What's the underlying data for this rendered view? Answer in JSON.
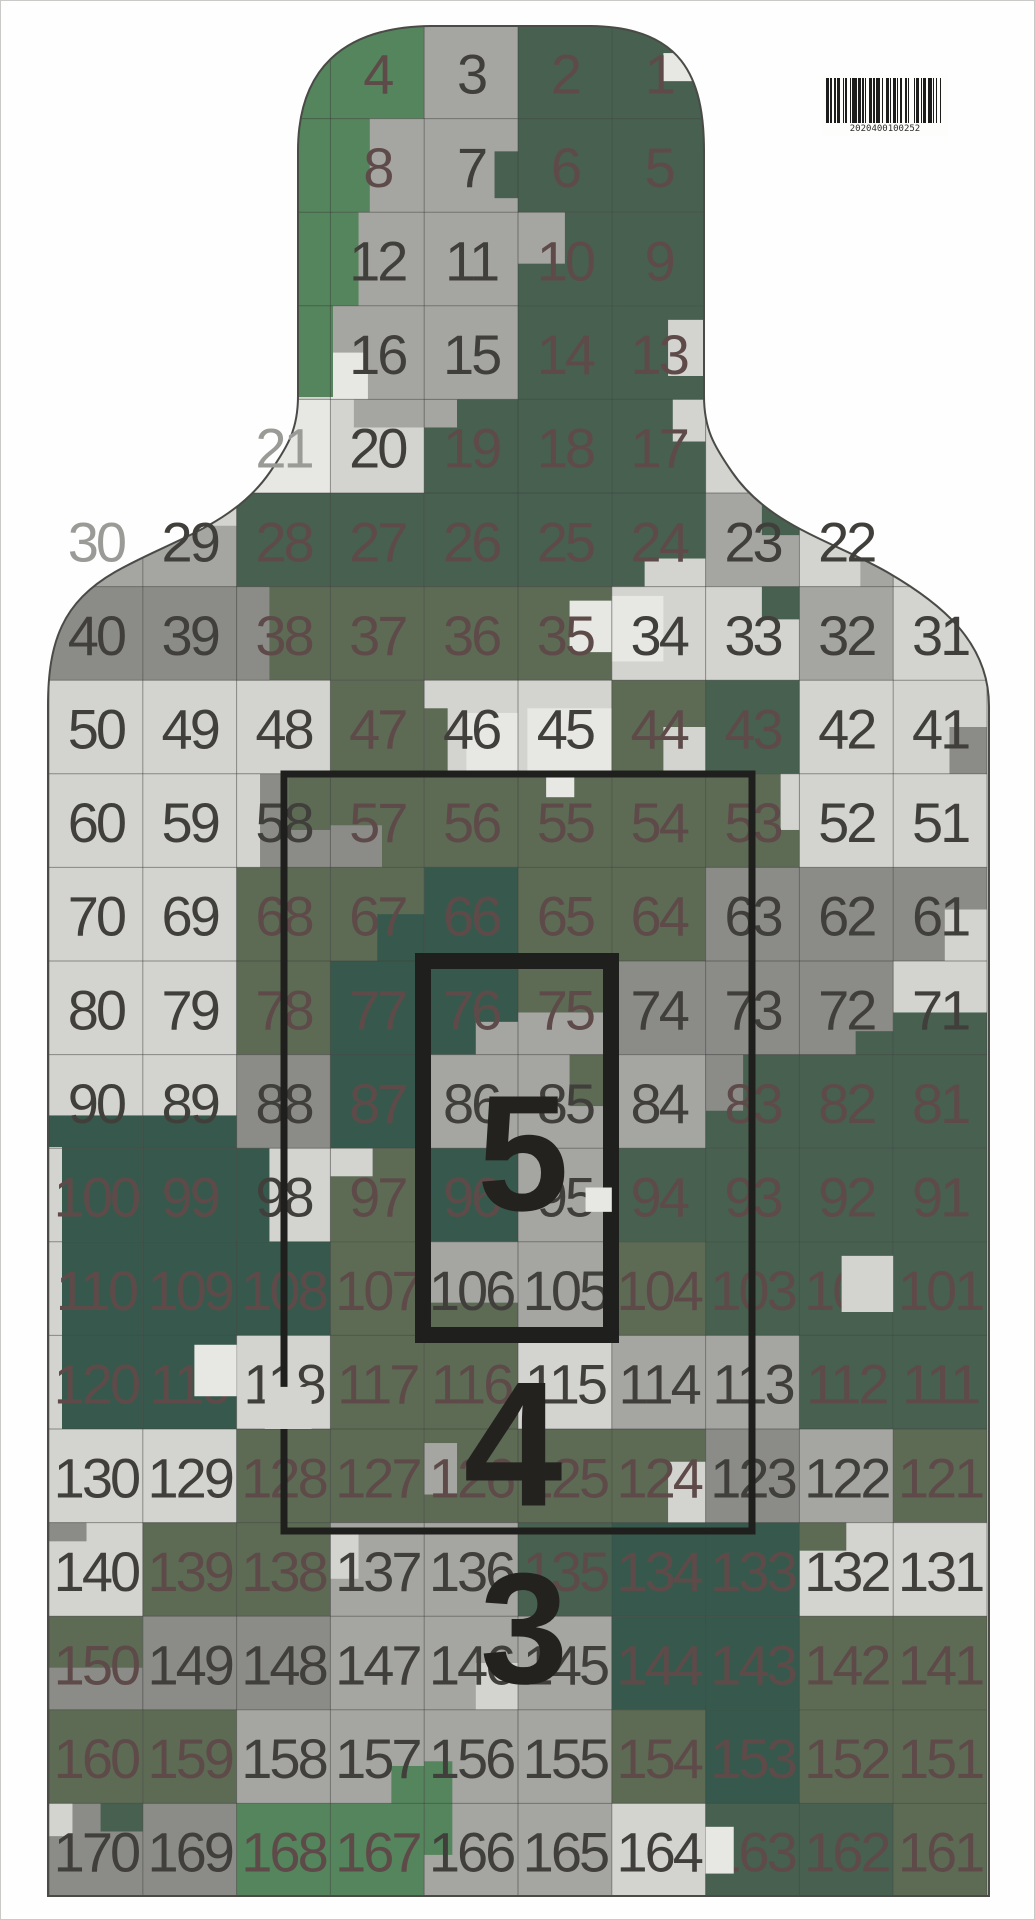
{
  "document": {
    "type": "camouflage-silhouette-shooting-target",
    "page_width": 1035,
    "page_height": 1920
  },
  "palette": {
    "W": "#e7e7e4",
    "L": "#d3d3d0",
    "M": "#a5a5a2",
    "G": "#8b8b88",
    "O": "#5d6b55",
    "D": "#47604f",
    "T": "#37594d",
    "B": "#55855c",
    "base": "#d3d3d0",
    "outline": "#4a4a47",
    "grid_line": "rgba(60,60,58,0.5)",
    "ring_stroke": "#1f1f1d",
    "label_color": "#23221f"
  },
  "inks": {
    "d": "#413f3b",
    "m": "#5e4b49",
    "g": "#9a9a97"
  },
  "grid": {
    "x0": 48,
    "y0": 24,
    "cw": 93.8,
    "rh": 93.6,
    "cols": 10,
    "rows": 20
  },
  "outline_path": "M 47 705 C 47 640 62 601 114 571 C 168 540 232 525 269 471 C 287 445 297 428 297 395 L 297 150 C 297 70 340 26 430 25 L 590 25 C 680 26 703 75 703 150 L 703 395 C 703 428 713 445 731 471 C 768 525 832 540 886 571 C 938 601 988 640 988 705 L 988 1895 L 47 1895 Z",
  "rows": [
    {
      "s": 3,
      "c": [
        [
          4,
          "B"
        ],
        [
          3,
          "M"
        ],
        [
          2,
          "D"
        ],
        [
          1,
          "D"
        ]
      ]
    },
    {
      "s": 3,
      "c": [
        [
          8,
          "M",
          "m"
        ],
        [
          7,
          "M"
        ],
        [
          6,
          "D"
        ],
        [
          5,
          "D"
        ]
      ]
    },
    {
      "s": 3,
      "c": [
        [
          12,
          "M"
        ],
        [
          11,
          "M"
        ],
        [
          10,
          "D"
        ],
        [
          9,
          "D"
        ]
      ]
    },
    {
      "s": 3,
      "c": [
        [
          16,
          "M"
        ],
        [
          15,
          "M"
        ],
        [
          14,
          "D"
        ],
        [
          13,
          "D"
        ]
      ]
    },
    {
      "s": 2,
      "c": [
        [
          21,
          "W",
          "g"
        ],
        [
          20,
          "L"
        ],
        [
          19,
          "D"
        ],
        [
          18,
          "D"
        ],
        [
          17,
          "D"
        ]
      ]
    },
    {
      "s": 0,
      "c": [
        [
          30,
          "W",
          "g"
        ],
        [
          29,
          "M"
        ],
        [
          28,
          "D"
        ],
        [
          27,
          "D"
        ],
        [
          26,
          "D"
        ],
        [
          25,
          "D"
        ],
        [
          24,
          "D"
        ],
        [
          23,
          "M"
        ],
        [
          22,
          "L"
        ]
      ]
    },
    {
      "s": 0,
      "c": [
        [
          40,
          "G"
        ],
        [
          39,
          "G"
        ],
        [
          38,
          "O"
        ],
        [
          37,
          "O"
        ],
        [
          36,
          "O"
        ],
        [
          35,
          "O"
        ],
        [
          34,
          "L"
        ],
        [
          33,
          "L"
        ],
        [
          32,
          "M"
        ],
        [
          31,
          "L"
        ]
      ]
    },
    {
      "s": 0,
      "c": [
        [
          50,
          "L"
        ],
        [
          49,
          "L"
        ],
        [
          48,
          "L"
        ],
        [
          47,
          "O"
        ],
        [
          46,
          "L"
        ],
        [
          45,
          "L"
        ],
        [
          44,
          "O"
        ],
        [
          43,
          "D"
        ],
        [
          42,
          "L"
        ],
        [
          41,
          "L"
        ]
      ]
    },
    {
      "s": 0,
      "c": [
        [
          60,
          "L"
        ],
        [
          59,
          "L"
        ],
        [
          58,
          "G"
        ],
        [
          57,
          "O"
        ],
        [
          56,
          "O"
        ],
        [
          55,
          "O"
        ],
        [
          54,
          "O"
        ],
        [
          53,
          "O"
        ],
        [
          52,
          "L"
        ],
        [
          51,
          "L"
        ]
      ]
    },
    {
      "s": 0,
      "c": [
        [
          70,
          "L"
        ],
        [
          69,
          "L"
        ],
        [
          68,
          "O"
        ],
        [
          67,
          "O"
        ],
        [
          66,
          "T"
        ],
        [
          65,
          "O"
        ],
        [
          64,
          "O"
        ],
        [
          63,
          "G"
        ],
        [
          62,
          "G"
        ],
        [
          61,
          "G"
        ]
      ]
    },
    {
      "s": 0,
      "c": [
        [
          80,
          "L"
        ],
        [
          79,
          "L"
        ],
        [
          78,
          "O"
        ],
        [
          77,
          "T"
        ],
        [
          76,
          "T"
        ],
        [
          75,
          "O"
        ],
        [
          74,
          "G"
        ],
        [
          73,
          "G"
        ],
        [
          72,
          "G"
        ],
        [
          71,
          "L"
        ]
      ]
    },
    {
      "s": 0,
      "c": [
        [
          90,
          "L"
        ],
        [
          89,
          "L"
        ],
        [
          88,
          "G"
        ],
        [
          87,
          "T"
        ],
        [
          86,
          "M"
        ],
        [
          85,
          "M"
        ],
        [
          84,
          "M"
        ],
        [
          83,
          "D"
        ],
        [
          82,
          "D"
        ],
        [
          81,
          "D"
        ]
      ]
    },
    {
      "s": 0,
      "c": [
        [
          100,
          "T"
        ],
        [
          99,
          "T"
        ],
        [
          98,
          "L"
        ],
        [
          97,
          "O"
        ],
        [
          96,
          "T"
        ],
        [
          95,
          "M"
        ],
        [
          94,
          "D"
        ],
        [
          93,
          "D"
        ],
        [
          92,
          "D"
        ],
        [
          91,
          "D"
        ]
      ]
    },
    {
      "s": 0,
      "c": [
        [
          110,
          "T"
        ],
        [
          109,
          "T"
        ],
        [
          108,
          "T"
        ],
        [
          107,
          "O"
        ],
        [
          106,
          "M"
        ],
        [
          105,
          "M"
        ],
        [
          104,
          "O"
        ],
        [
          103,
          "D"
        ],
        [
          102,
          "D"
        ],
        [
          101,
          "D"
        ]
      ]
    },
    {
      "s": 0,
      "c": [
        [
          120,
          "T"
        ],
        [
          119,
          "T"
        ],
        [
          118,
          "L"
        ],
        [
          117,
          "O"
        ],
        [
          116,
          "O"
        ],
        [
          115,
          "L"
        ],
        [
          114,
          "M"
        ],
        [
          113,
          "M"
        ],
        [
          112,
          "D"
        ],
        [
          111,
          "D"
        ]
      ]
    },
    {
      "s": 0,
      "c": [
        [
          130,
          "L"
        ],
        [
          129,
          "L"
        ],
        [
          128,
          "O"
        ],
        [
          127,
          "O"
        ],
        [
          126,
          "O"
        ],
        [
          125,
          "O"
        ],
        [
          124,
          "O"
        ],
        [
          123,
          "G"
        ],
        [
          122,
          "M"
        ],
        [
          121,
          "O"
        ]
      ]
    },
    {
      "s": 0,
      "c": [
        [
          140,
          "L"
        ],
        [
          139,
          "O"
        ],
        [
          138,
          "O"
        ],
        [
          137,
          "M"
        ],
        [
          136,
          "M"
        ],
        [
          135,
          "D"
        ],
        [
          134,
          "T"
        ],
        [
          133,
          "T"
        ],
        [
          132,
          "L"
        ],
        [
          131,
          "L"
        ]
      ]
    },
    {
      "s": 0,
      "c": [
        [
          150,
          "O"
        ],
        [
          149,
          "G"
        ],
        [
          148,
          "G"
        ],
        [
          147,
          "M"
        ],
        [
          146,
          "M"
        ],
        [
          145,
          "M"
        ],
        [
          144,
          "T"
        ],
        [
          143,
          "T"
        ],
        [
          142,
          "O"
        ],
        [
          141,
          "O"
        ]
      ]
    },
    {
      "s": 0,
      "c": [
        [
          160,
          "O"
        ],
        [
          159,
          "O"
        ],
        [
          158,
          "M"
        ],
        [
          157,
          "M"
        ],
        [
          156,
          "M"
        ],
        [
          155,
          "M"
        ],
        [
          154,
          "O"
        ],
        [
          153,
          "T"
        ],
        [
          152,
          "O"
        ],
        [
          151,
          "O"
        ]
      ]
    },
    {
      "s": 0,
      "c": [
        [
          170,
          "G"
        ],
        [
          169,
          "G"
        ],
        [
          168,
          "B"
        ],
        [
          167,
          "B"
        ],
        [
          166,
          "M"
        ],
        [
          165,
          "M"
        ],
        [
          164,
          "L"
        ],
        [
          163,
          "D"
        ],
        [
          162,
          "D"
        ],
        [
          161,
          "O"
        ]
      ]
    }
  ],
  "patches": [
    [
      0,
      6,
      "W",
      0.55,
      0.3,
      0.4,
      0.3
    ],
    [
      1,
      3,
      "B",
      0,
      0,
      0.42,
      1
    ],
    [
      1,
      4,
      "D",
      0.75,
      0.35,
      0.25,
      0.5
    ],
    [
      2,
      3,
      "B",
      0,
      0,
      0.3,
      1
    ],
    [
      2,
      5,
      "M",
      0,
      0,
      0.5,
      0.55
    ],
    [
      3,
      3,
      "W",
      0,
      0.5,
      0.4,
      0.5
    ],
    [
      3,
      6,
      "L",
      0.6,
      0.15,
      0.4,
      0.6
    ],
    [
      4,
      3,
      "M",
      0.25,
      0,
      0.75,
      0.3
    ],
    [
      4,
      4,
      "M",
      0,
      0,
      0.35,
      0.3
    ],
    [
      4,
      6,
      "L",
      0.65,
      0,
      0.35,
      0.45
    ],
    [
      5,
      0,
      "M",
      0,
      0.55,
      1,
      0.45
    ],
    [
      5,
      1,
      "L",
      0,
      0,
      1,
      0.35
    ],
    [
      5,
      6,
      "L",
      0.35,
      0.7,
      0.65,
      0.3
    ],
    [
      5,
      7,
      "D",
      0.6,
      0,
      0.4,
      0.45
    ],
    [
      5,
      8,
      "M",
      0.65,
      0.35,
      0.35,
      0.65
    ],
    [
      6,
      2,
      "G",
      0,
      0,
      0.35,
      1
    ],
    [
      6,
      5,
      "W",
      0.55,
      0.15,
      0.45,
      0.55
    ],
    [
      6,
      6,
      "W",
      0,
      0.1,
      0.55,
      0.7
    ],
    [
      6,
      7,
      "D",
      0.6,
      0,
      0.4,
      0.35
    ],
    [
      7,
      4,
      "O",
      0,
      0.3,
      0.25,
      0.7
    ],
    [
      7,
      4,
      "W",
      0.45,
      0.35,
      0.55,
      0.65
    ],
    [
      7,
      5,
      "W",
      0.1,
      0.3,
      0.9,
      0.7
    ],
    [
      7,
      6,
      "L",
      0.55,
      0.5,
      0.45,
      0.5
    ],
    [
      7,
      9,
      "G",
      0.6,
      0.5,
      0.4,
      0.5
    ],
    [
      8,
      2,
      "O",
      0.55,
      0,
      0.45,
      0.6
    ],
    [
      8,
      2,
      "L",
      0,
      0,
      0.25,
      1
    ],
    [
      8,
      3,
      "G",
      0,
      0.55,
      0.55,
      0.45
    ],
    [
      8,
      5,
      "W",
      0.3,
      0,
      0.3,
      0.25
    ],
    [
      8,
      7,
      "L",
      0.8,
      0,
      0.2,
      0.6
    ],
    [
      9,
      3,
      "T",
      0.5,
      0.5,
      0.5,
      0.5
    ],
    [
      9,
      9,
      "L",
      0.55,
      0.45,
      0.45,
      0.55
    ],
    [
      10,
      4,
      "M",
      0.55,
      0.65,
      0.45,
      0.35
    ],
    [
      10,
      5,
      "M",
      0,
      0.55,
      1,
      0.45
    ],
    [
      10,
      8,
      "D",
      0.6,
      0.75,
      0.4,
      0.25
    ],
    [
      10,
      9,
      "D",
      0,
      0.55,
      1,
      0.45
    ],
    [
      11,
      0,
      "T",
      0,
      0.65,
      1,
      0.35
    ],
    [
      11,
      1,
      "T",
      0,
      0.65,
      1,
      0.35
    ],
    [
      11,
      5,
      "O",
      0.55,
      0,
      0.45,
      0.55
    ],
    [
      11,
      7,
      "G",
      0,
      0,
      0.4,
      0.6
    ],
    [
      12,
      2,
      "T",
      0,
      0,
      0.35,
      1
    ],
    [
      12,
      3,
      "L",
      0,
      0,
      0.45,
      0.3
    ],
    [
      13,
      4,
      "O",
      0,
      0.65,
      1,
      0.35
    ],
    [
      15,
      4,
      "M",
      0,
      0.15,
      0.35,
      0.55
    ],
    [
      15,
      6,
      "L",
      0.6,
      0.35,
      0.4,
      0.65
    ],
    [
      16,
      0,
      "G",
      0,
      0,
      0.4,
      0.2
    ],
    [
      16,
      3,
      "L",
      0,
      0.1,
      0.3,
      0.5
    ],
    [
      16,
      8,
      "O",
      0,
      0,
      0.5,
      0.3
    ],
    [
      17,
      0,
      "G",
      0,
      0.55,
      1,
      0.45
    ],
    [
      17,
      4,
      "L",
      0.55,
      0.5,
      0.45,
      0.5
    ],
    [
      18,
      3,
      "B",
      0.65,
      0.6,
      0.35,
      0.4
    ],
    [
      18,
      4,
      "B",
      0,
      0.55,
      0.3,
      0.45
    ],
    [
      19,
      0,
      "L",
      0,
      0,
      0.25,
      0.35
    ],
    [
      19,
      0,
      "D",
      0.55,
      0,
      0.45,
      0.3
    ],
    [
      19,
      4,
      "B",
      0,
      0,
      0.3,
      0.55
    ]
  ],
  "abs_patches": [
    {
      "c": "B",
      "x": 296,
      "y": 28,
      "w": 36,
      "h": 368
    },
    {
      "c": "L",
      "x": 47,
      "y": 1146,
      "w": 14,
      "h": 290
    }
  ],
  "top_patches": [
    [
      12,
      5,
      "W",
      0.72,
      0.42,
      0.28,
      0.26
    ],
    [
      13,
      8,
      "L",
      0.45,
      0.15,
      0.55,
      0.6
    ],
    [
      14,
      1,
      "W",
      0.55,
      0.1,
      0.45,
      0.55
    ],
    [
      14,
      2,
      "L",
      0.3,
      0.55,
      0.5,
      0.45
    ],
    [
      19,
      7,
      "W",
      0,
      0.25,
      0.3,
      0.5
    ]
  ],
  "rings": [
    {
      "name": "ring-5",
      "x": 422,
      "y": 960,
      "w": 188,
      "h": 374,
      "stroke": 16
    },
    {
      "name": "ring-4",
      "x": 283,
      "y": 773,
      "w": 468,
      "h": 757,
      "stroke": 7
    }
  ],
  "score_labels": [
    {
      "text": "5",
      "x": 522,
      "y": 1152,
      "size": 165
    },
    {
      "text": "4",
      "x": 512,
      "y": 1443,
      "size": 178
    },
    {
      "text": "3",
      "x": 523,
      "y": 1628,
      "size": 158
    }
  ],
  "cell_number_style": {
    "font_size": 56,
    "letter_spacing": -3
  },
  "barcode": {
    "x": 821,
    "y": 73,
    "w": 126,
    "h": 62,
    "text": "2020400100252",
    "bar_color": "#1c1c1c",
    "bars": [
      2,
      1,
      1,
      2,
      1,
      1,
      2,
      2,
      1,
      1,
      1,
      2,
      1,
      1,
      3,
      1,
      2,
      1,
      1,
      1,
      1,
      2,
      2,
      1,
      1,
      1,
      3,
      1,
      1,
      2,
      2,
      1,
      1,
      1,
      2,
      1,
      1,
      1,
      2,
      2,
      1,
      1,
      1,
      3,
      1,
      1,
      2,
      1,
      1,
      1,
      2,
      1,
      3,
      1,
      1,
      1,
      1,
      2,
      1,
      2
    ]
  }
}
